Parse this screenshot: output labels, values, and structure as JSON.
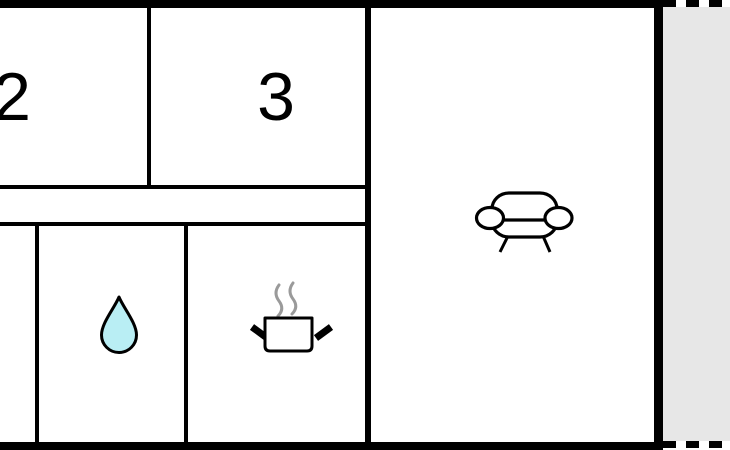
{
  "floor_plan": {
    "type": "apartment-floor-plan",
    "rooms": {
      "bedroom_2": {
        "label": "2"
      },
      "bedroom_3": {
        "label": "3"
      },
      "hallway": {
        "label": ""
      },
      "closet": {
        "label": ""
      },
      "bathroom": {
        "icon": "water-drop-icon"
      },
      "kitchen": {
        "icon": "steaming-pot-icon"
      },
      "living_room": {
        "icon": "sofa-icon"
      },
      "terrace": {
        "border_style": "dashed"
      }
    },
    "colors": {
      "wall": "#000000",
      "room_fill": "#ffffff",
      "water_drop_fill": "#b9eef4",
      "terrace_fill": "#e7e7e7",
      "steam": "#9a9a9a"
    }
  }
}
